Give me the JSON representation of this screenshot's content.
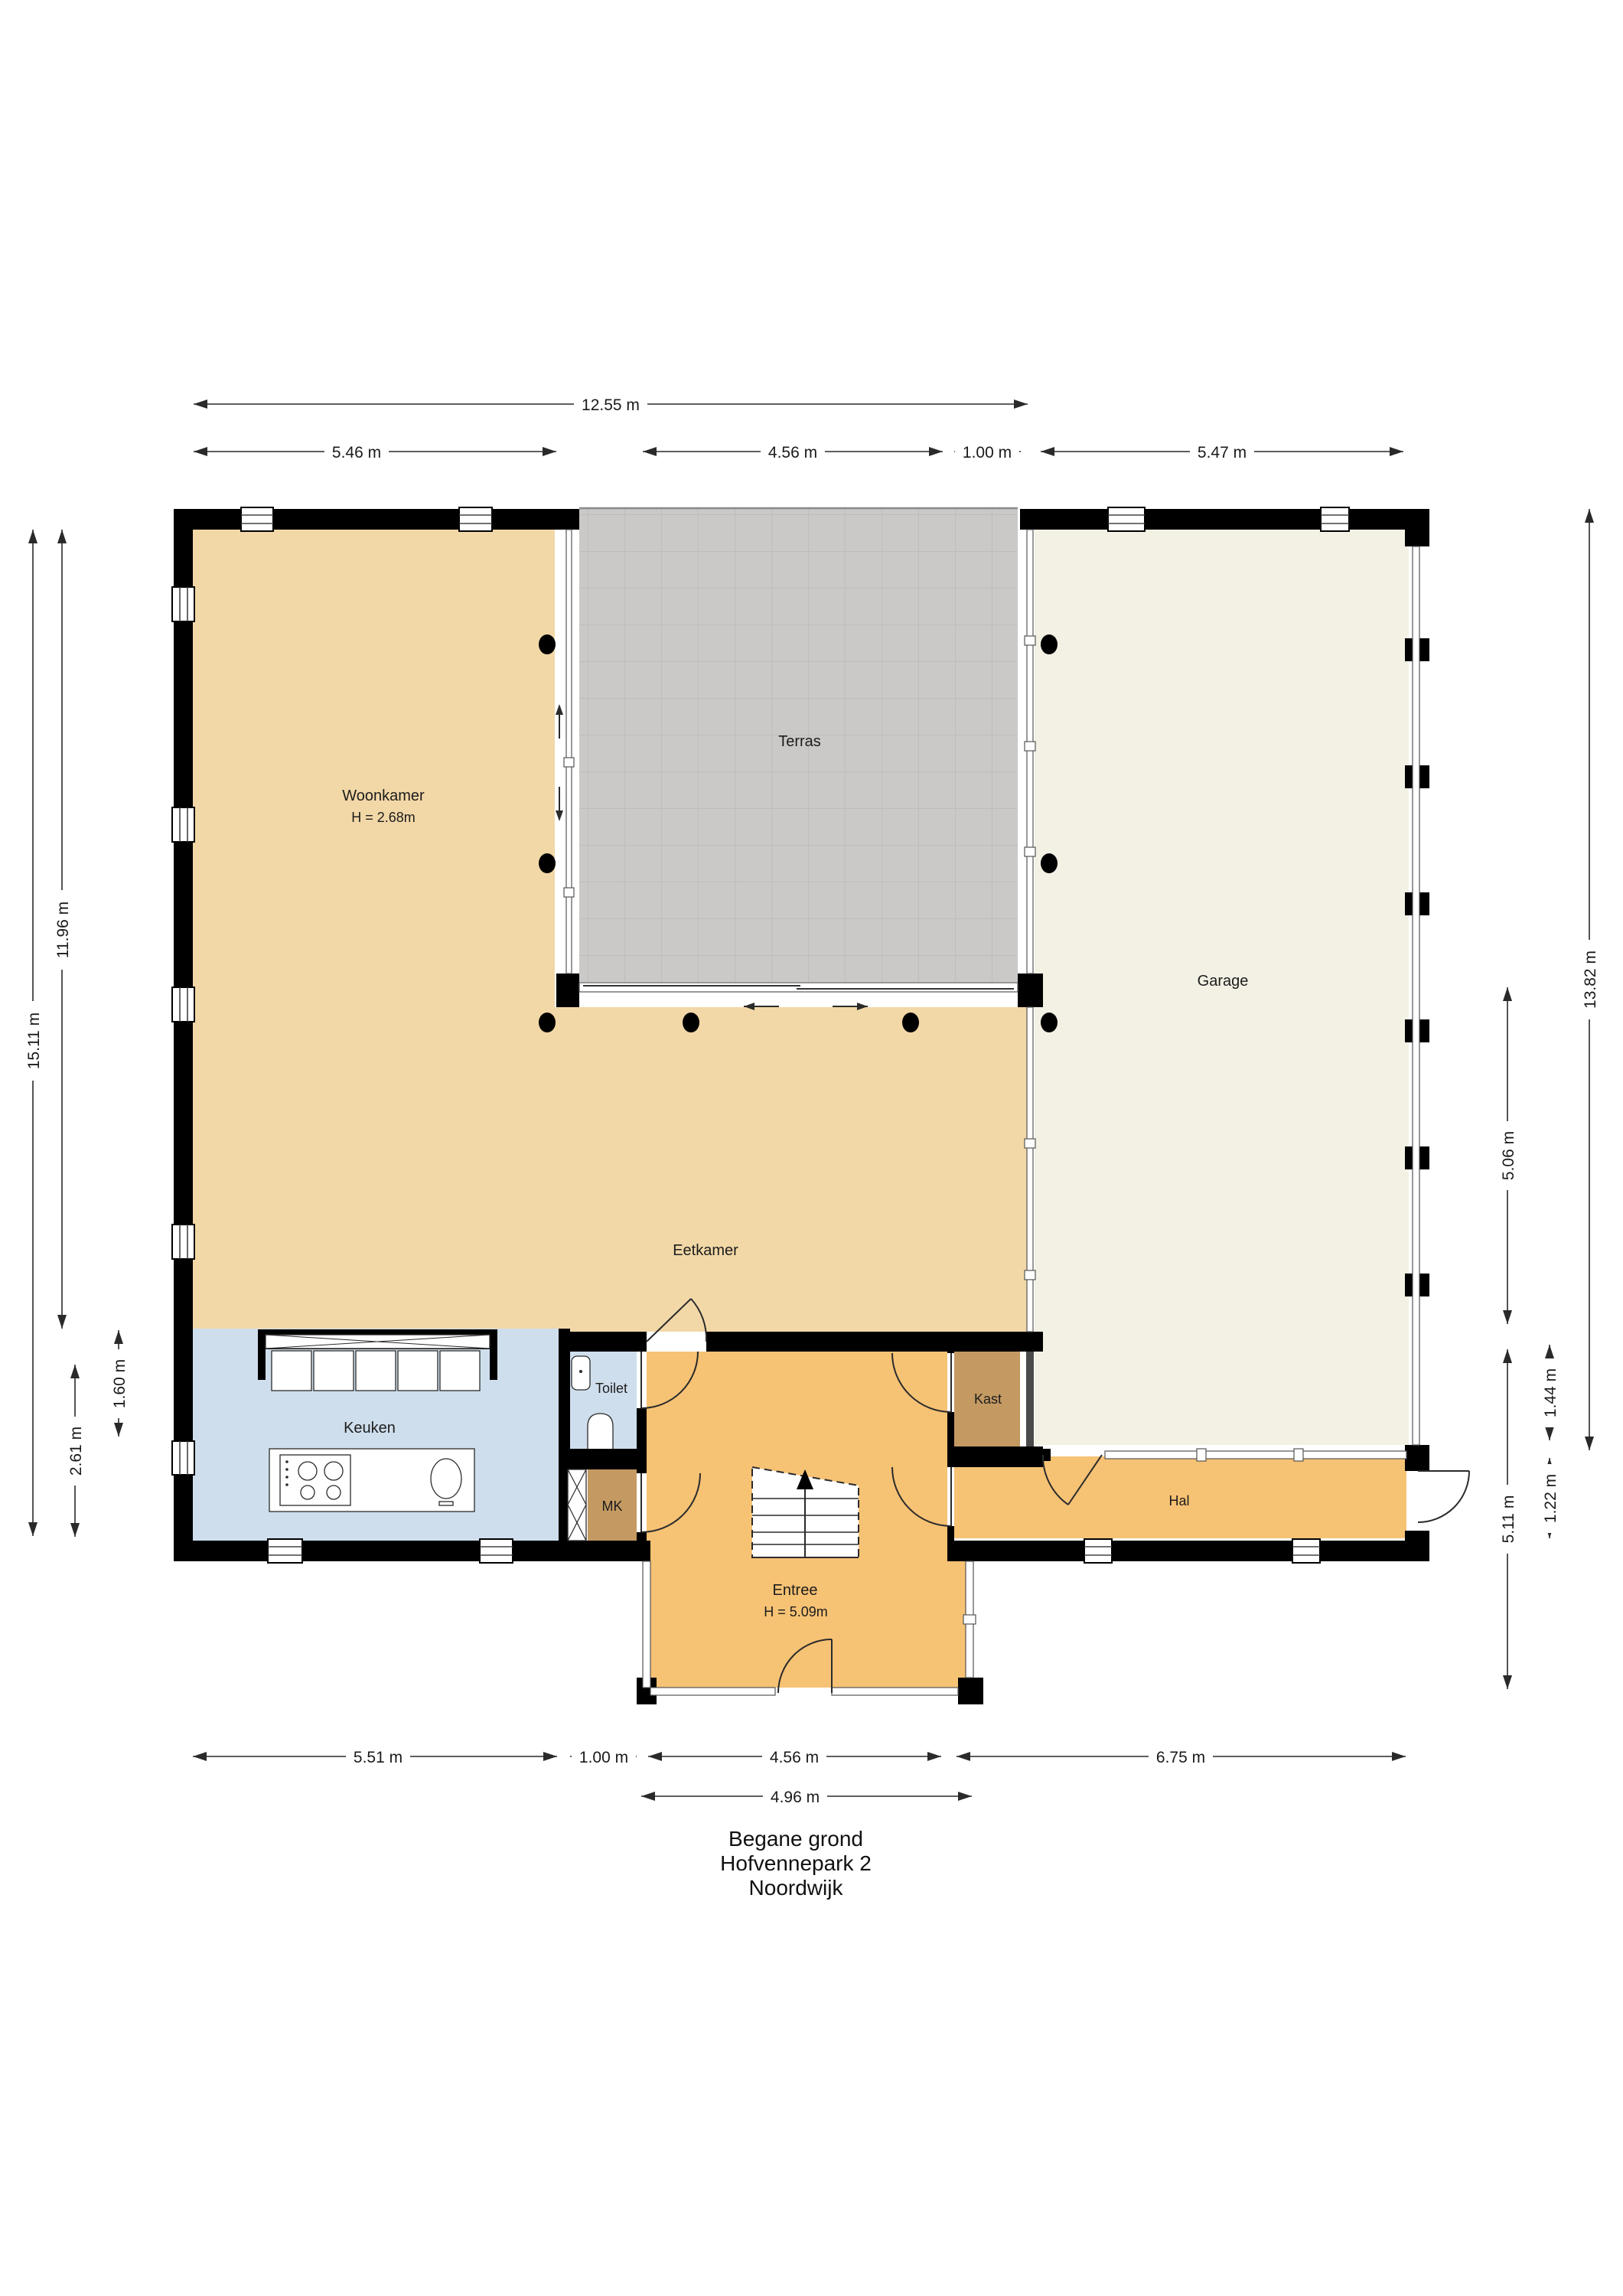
{
  "title": {
    "lines": [
      "Begane grond",
      "Hofvennepark 2",
      "Noordwijk"
    ]
  },
  "rooms": {
    "woonkamer": {
      "label": "Woonkamer",
      "height_note": "H = 2.68m"
    },
    "terras": {
      "label": "Terras"
    },
    "garage": {
      "label": "Garage"
    },
    "eetkamer": {
      "label": "Eetkamer"
    },
    "keuken": {
      "label": "Keuken"
    },
    "toilet": {
      "label": "Toilet"
    },
    "mk": {
      "label": "MK"
    },
    "kast": {
      "label": "Kast"
    },
    "hal": {
      "label": "Hal"
    },
    "entree": {
      "label": "Entree",
      "height_note": "H = 5.09m"
    }
  },
  "dimensions": {
    "top": [
      "12.55 m",
      "5.46 m",
      "4.56 m",
      "1.00 m",
      "5.47 m"
    ],
    "bottom": [
      "5.51 m",
      "1.00 m",
      "4.56 m",
      "6.75 m",
      "4.96 m"
    ],
    "left": [
      "15.11 m",
      "11.96 m",
      "2.61 m",
      "1.60 m"
    ],
    "right": [
      "13.82 m",
      "5.06 m",
      "1.44 m",
      "1.22 m",
      "5.11 m"
    ]
  },
  "colors": {
    "wall": "#000000",
    "living": "#f2d8a7",
    "terrace": "#cac9c7",
    "garage": "#f3f1e4",
    "kitchen": "#cfdeed",
    "closet": "#c49a62",
    "hall": "#f6c274",
    "shaft_door": "#4a4a4a"
  }
}
